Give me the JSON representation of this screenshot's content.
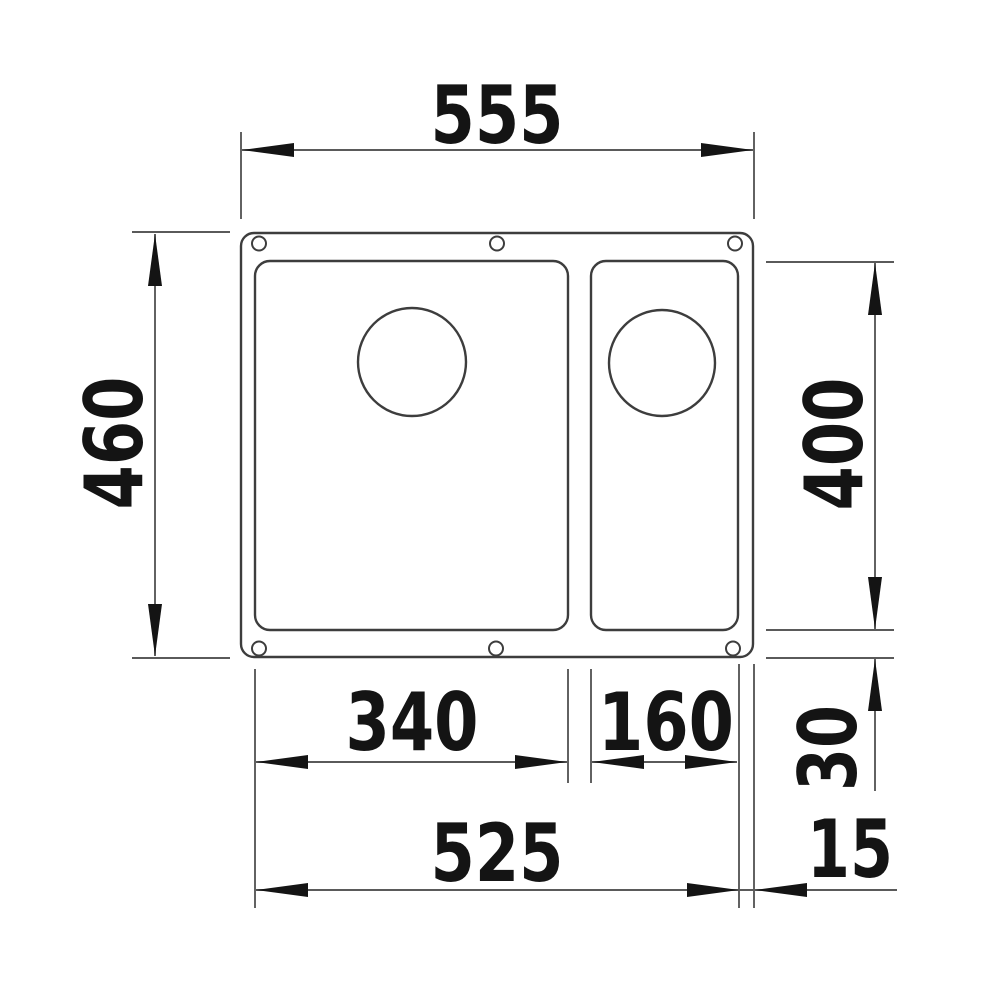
{
  "drawing": {
    "description": "Undermount sink cutout plan view with one and a half bowls and drain holes",
    "units_note": "",
    "dimensions": {
      "overall_width": "555",
      "overall_height": "460",
      "bowl_length": "400",
      "main_bowl_width": "340",
      "small_bowl_width": "160",
      "bottom_rim_offset": "30",
      "bowl_span_width": "525",
      "side_rim_offset": "15"
    },
    "colors": {
      "background": "#ffffff",
      "outline": "#3d3d3d",
      "dimension_lines": "#5a5a5a",
      "text_and_arrows": "#141414"
    }
  }
}
